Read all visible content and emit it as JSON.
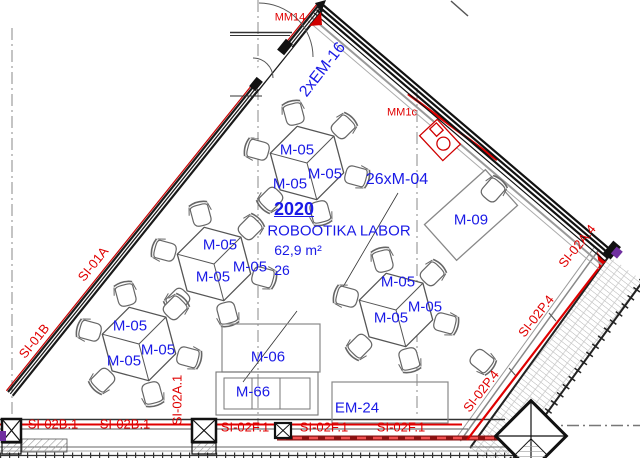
{
  "drawing": {
    "type": "architectural-floor-plan",
    "room": {
      "number": "2020",
      "name": "ROBOOTIKA LABOR",
      "area": "62,9 m²",
      "capacity": "26"
    }
  },
  "colors": {
    "blue": "#1a1ae6",
    "red": "#e00000",
    "dark_red": "#8a1212",
    "purple": "#7030a0",
    "wall": "#1a1a1a"
  },
  "annotations": [
    {
      "name": "label-2xem16",
      "text": "2xEM-16",
      "x": 323,
      "y": 70,
      "rot": -52,
      "size": 16,
      "color": "blue"
    },
    {
      "name": "label-26xm04",
      "text": "26xM-04",
      "x": 397,
      "y": 180,
      "size": 16,
      "color": "blue"
    },
    {
      "name": "room-number",
      "text": "2020",
      "x": 294,
      "y": 209,
      "size": 18,
      "bold": true,
      "underline": true,
      "color": "blue"
    },
    {
      "name": "room-name",
      "text": "ROBOOTIKA LABOR",
      "x": 339,
      "y": 231,
      "size": 15,
      "color": "blue"
    },
    {
      "name": "room-area",
      "text": "62,9 m²",
      "x": 298,
      "y": 250,
      "size": 14,
      "color": "blue"
    },
    {
      "name": "room-capacity",
      "text": "26",
      "x": 282,
      "y": 270,
      "size": 14,
      "color": "blue"
    },
    {
      "name": "label-m05-t1a",
      "text": "M-05",
      "x": 297,
      "y": 150,
      "size": 15,
      "color": "blue"
    },
    {
      "name": "label-m05-t1b",
      "text": "M-05",
      "x": 325,
      "y": 174,
      "size": 15,
      "color": "blue"
    },
    {
      "name": "label-m05-t1c",
      "text": "M-05",
      "x": 290,
      "y": 184,
      "size": 15,
      "color": "blue"
    },
    {
      "name": "label-m05-t2a",
      "text": "M-05",
      "x": 220,
      "y": 245,
      "size": 15,
      "color": "blue"
    },
    {
      "name": "label-m05-t2b",
      "text": "M-05",
      "x": 250,
      "y": 267,
      "size": 15,
      "color": "blue"
    },
    {
      "name": "label-m05-t2c",
      "text": "M-05",
      "x": 213,
      "y": 277,
      "size": 15,
      "color": "blue"
    },
    {
      "name": "label-m05-t3a",
      "text": "M-05",
      "x": 130,
      "y": 326,
      "size": 15,
      "color": "blue"
    },
    {
      "name": "label-m05-t3b",
      "text": "M-05",
      "x": 158,
      "y": 350,
      "size": 15,
      "color": "blue"
    },
    {
      "name": "label-m05-t3c",
      "text": "M-05",
      "x": 124,
      "y": 361,
      "size": 15,
      "color": "blue"
    },
    {
      "name": "label-m05-t4a",
      "text": "M-05",
      "x": 398,
      "y": 282,
      "size": 15,
      "color": "blue"
    },
    {
      "name": "label-m05-t4b",
      "text": "M-05",
      "x": 425,
      "y": 307,
      "size": 15,
      "color": "blue"
    },
    {
      "name": "label-m05-t4c",
      "text": "M-05",
      "x": 391,
      "y": 318,
      "size": 15,
      "color": "blue"
    },
    {
      "name": "label-m09",
      "text": "M-09",
      "x": 471,
      "y": 220,
      "size": 15,
      "color": "blue"
    },
    {
      "name": "label-m06",
      "text": "M-06",
      "x": 268,
      "y": 357,
      "size": 15,
      "color": "blue"
    },
    {
      "name": "label-m66",
      "text": "M-66",
      "x": 253,
      "y": 392,
      "size": 15,
      "color": "blue"
    },
    {
      "name": "label-em24",
      "text": "EM-24",
      "x": 357,
      "y": 408,
      "size": 15,
      "color": "blue"
    },
    {
      "name": "label-mm14",
      "text": "MM14",
      "x": 290,
      "y": 18,
      "size": 11,
      "color": "red"
    },
    {
      "name": "label-mm1c",
      "text": "MM1c",
      "x": 402,
      "y": 113,
      "size": 11,
      "color": "red"
    },
    {
      "name": "label-si01a",
      "text": "SI-01A",
      "x": 93,
      "y": 264,
      "rot": -51,
      "size": 13,
      "color": "red"
    },
    {
      "name": "label-si01b",
      "text": "SI-01B",
      "x": 34,
      "y": 341,
      "rot": -51,
      "size": 13,
      "color": "red"
    },
    {
      "name": "label-si02a4",
      "text": "SI-02A.4",
      "x": 577,
      "y": 246,
      "rot": -51,
      "size": 13,
      "color": "red"
    },
    {
      "name": "label-si02p4-upper",
      "text": "SI-02P.4",
      "x": 536,
      "y": 316,
      "rot": -52,
      "size": 13,
      "color": "red"
    },
    {
      "name": "label-si02p4-lower",
      "text": "SI-02P.4",
      "x": 481,
      "y": 391,
      "rot": -52,
      "size": 13,
      "color": "red"
    },
    {
      "name": "label-si02b1-a",
      "text": "SI-02B.1",
      "x": 53,
      "y": 424,
      "size": 13,
      "color": "red"
    },
    {
      "name": "label-si02b1-b",
      "text": "SI-02B.1",
      "x": 125,
      "y": 424,
      "size": 13,
      "color": "red"
    },
    {
      "name": "label-si02a1",
      "text": "SI-02A.1",
      "x": 177,
      "y": 400,
      "rot": -90,
      "size": 13,
      "color": "red"
    },
    {
      "name": "label-si02f1-a",
      "text": "SI-02F.1",
      "x": 245,
      "y": 427,
      "size": 13,
      "color": "red"
    },
    {
      "name": "label-si02f1-b",
      "text": "SI-02F.1",
      "x": 324,
      "y": 427,
      "size": 13,
      "color": "red"
    },
    {
      "name": "label-si02f1-c",
      "text": "SI-02F.1",
      "x": 401,
      "y": 427,
      "size": 13,
      "color": "red"
    }
  ]
}
